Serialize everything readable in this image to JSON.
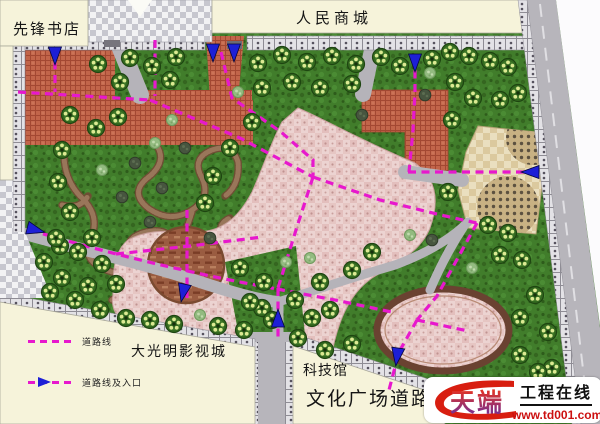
{
  "labels": {
    "bookstore": "先锋书店",
    "mall": "人民商城",
    "film_city": "大光明影视城",
    "science_museum": "科技馆",
    "culture_road": "文化广场道路"
  },
  "legend": {
    "items": [
      {
        "symbol": "dashed-line",
        "label": "道路线"
      },
      {
        "symbol": "dashed-line-entrance-arrow",
        "label": "道路线及入口"
      }
    ]
  },
  "watermark": {
    "brand": "天端",
    "title": "工程在线",
    "url": "www.td001.com"
  },
  "colors": {
    "road_line_magenta": "#e718cd",
    "entrance_arrow_blue": "#1d1fd6",
    "building_cream": "#f6f3da",
    "plaza_red": "#c2654a",
    "plaza_pink": "#ecd3d1",
    "grass_green": "#417d2b",
    "road_gray": "#b7b5bb",
    "watermark_red": "#d81e10"
  },
  "map": {
    "planting": [
      {
        "x": 98,
        "y": 64,
        "t": "t"
      },
      {
        "x": 130,
        "y": 58,
        "t": "t"
      },
      {
        "x": 152,
        "y": 66,
        "t": "t"
      },
      {
        "x": 176,
        "y": 57,
        "t": "t"
      },
      {
        "x": 258,
        "y": 63,
        "t": "t"
      },
      {
        "x": 282,
        "y": 55,
        "t": "t"
      },
      {
        "x": 307,
        "y": 62,
        "t": "t"
      },
      {
        "x": 332,
        "y": 56,
        "t": "t"
      },
      {
        "x": 356,
        "y": 64,
        "t": "t"
      },
      {
        "x": 381,
        "y": 57,
        "t": "t"
      },
      {
        "x": 400,
        "y": 66,
        "t": "t"
      },
      {
        "x": 432,
        "y": 59,
        "t": "t"
      },
      {
        "x": 450,
        "y": 52,
        "t": "t"
      },
      {
        "x": 469,
        "y": 56,
        "t": "t"
      },
      {
        "x": 490,
        "y": 61,
        "t": "t"
      },
      {
        "x": 508,
        "y": 67,
        "t": "t"
      },
      {
        "x": 120,
        "y": 82,
        "t": "t"
      },
      {
        "x": 170,
        "y": 80,
        "t": "t"
      },
      {
        "x": 262,
        "y": 88,
        "t": "t"
      },
      {
        "x": 292,
        "y": 82,
        "t": "t"
      },
      {
        "x": 320,
        "y": 88,
        "t": "t"
      },
      {
        "x": 352,
        "y": 84,
        "t": "t"
      },
      {
        "x": 455,
        "y": 82,
        "t": "t"
      },
      {
        "x": 473,
        "y": 98,
        "t": "t"
      },
      {
        "x": 500,
        "y": 100,
        "t": "t"
      },
      {
        "x": 518,
        "y": 93,
        "t": "t"
      },
      {
        "x": 238,
        "y": 92,
        "t": "s"
      },
      {
        "x": 430,
        "y": 73,
        "t": "s"
      },
      {
        "x": 362,
        "y": 115,
        "t": "d"
      },
      {
        "x": 425,
        "y": 95,
        "t": "d"
      },
      {
        "x": 252,
        "y": 122,
        "t": "t"
      },
      {
        "x": 230,
        "y": 148,
        "t": "t"
      },
      {
        "x": 213,
        "y": 176,
        "t": "t"
      },
      {
        "x": 205,
        "y": 203,
        "t": "t"
      },
      {
        "x": 452,
        "y": 120,
        "t": "t"
      },
      {
        "x": 448,
        "y": 192,
        "t": "t"
      },
      {
        "x": 70,
        "y": 115,
        "t": "t"
      },
      {
        "x": 96,
        "y": 128,
        "t": "t"
      },
      {
        "x": 62,
        "y": 150,
        "t": "t"
      },
      {
        "x": 58,
        "y": 182,
        "t": "t"
      },
      {
        "x": 70,
        "y": 212,
        "t": "t"
      },
      {
        "x": 92,
        "y": 238,
        "t": "t"
      },
      {
        "x": 60,
        "y": 246,
        "t": "t"
      },
      {
        "x": 118,
        "y": 117,
        "t": "t"
      },
      {
        "x": 135,
        "y": 163,
        "t": "d"
      },
      {
        "x": 162,
        "y": 188,
        "t": "d"
      },
      {
        "x": 185,
        "y": 148,
        "t": "d"
      },
      {
        "x": 122,
        "y": 197,
        "t": "d"
      },
      {
        "x": 150,
        "y": 222,
        "t": "d"
      },
      {
        "x": 210,
        "y": 238,
        "t": "d"
      },
      {
        "x": 155,
        "y": 143,
        "t": "s"
      },
      {
        "x": 102,
        "y": 170,
        "t": "s"
      },
      {
        "x": 172,
        "y": 120,
        "t": "s"
      },
      {
        "x": 44,
        "y": 262,
        "t": "t"
      },
      {
        "x": 56,
        "y": 238,
        "t": "t"
      },
      {
        "x": 78,
        "y": 252,
        "t": "t"
      },
      {
        "x": 102,
        "y": 264,
        "t": "t"
      },
      {
        "x": 62,
        "y": 278,
        "t": "t"
      },
      {
        "x": 88,
        "y": 286,
        "t": "t"
      },
      {
        "x": 116,
        "y": 284,
        "t": "t"
      },
      {
        "x": 50,
        "y": 292,
        "t": "t"
      },
      {
        "x": 75,
        "y": 300,
        "t": "t"
      },
      {
        "x": 100,
        "y": 310,
        "t": "t"
      },
      {
        "x": 126,
        "y": 318,
        "t": "t"
      },
      {
        "x": 150,
        "y": 320,
        "t": "t"
      },
      {
        "x": 174,
        "y": 324,
        "t": "t"
      },
      {
        "x": 218,
        "y": 326,
        "t": "t"
      },
      {
        "x": 244,
        "y": 330,
        "t": "t"
      },
      {
        "x": 262,
        "y": 308,
        "t": "t"
      },
      {
        "x": 200,
        "y": 315,
        "t": "s"
      },
      {
        "x": 240,
        "y": 268,
        "t": "t"
      },
      {
        "x": 264,
        "y": 282,
        "t": "t"
      },
      {
        "x": 250,
        "y": 302,
        "t": "t"
      },
      {
        "x": 272,
        "y": 320,
        "t": "t"
      },
      {
        "x": 295,
        "y": 300,
        "t": "t"
      },
      {
        "x": 312,
        "y": 318,
        "t": "t"
      },
      {
        "x": 298,
        "y": 338,
        "t": "t"
      },
      {
        "x": 330,
        "y": 310,
        "t": "t"
      },
      {
        "x": 320,
        "y": 282,
        "t": "t"
      },
      {
        "x": 286,
        "y": 262,
        "t": "s"
      },
      {
        "x": 310,
        "y": 258,
        "t": "s"
      },
      {
        "x": 352,
        "y": 270,
        "t": "t"
      },
      {
        "x": 372,
        "y": 252,
        "t": "t"
      },
      {
        "x": 488,
        "y": 225,
        "t": "t"
      },
      {
        "x": 508,
        "y": 233,
        "t": "t"
      },
      {
        "x": 522,
        "y": 260,
        "t": "t"
      },
      {
        "x": 535,
        "y": 295,
        "t": "t"
      },
      {
        "x": 548,
        "y": 332,
        "t": "t"
      },
      {
        "x": 552,
        "y": 368,
        "t": "t"
      },
      {
        "x": 558,
        "y": 398,
        "t": "t"
      },
      {
        "x": 520,
        "y": 318,
        "t": "t"
      },
      {
        "x": 500,
        "y": 255,
        "t": "t"
      },
      {
        "x": 432,
        "y": 240,
        "t": "d"
      },
      {
        "x": 472,
        "y": 268,
        "t": "s"
      },
      {
        "x": 410,
        "y": 235,
        "t": "s"
      },
      {
        "x": 325,
        "y": 350,
        "t": "t"
      },
      {
        "x": 352,
        "y": 344,
        "t": "t"
      },
      {
        "x": 520,
        "y": 355,
        "t": "t"
      },
      {
        "x": 538,
        "y": 372,
        "t": "t"
      }
    ]
  }
}
